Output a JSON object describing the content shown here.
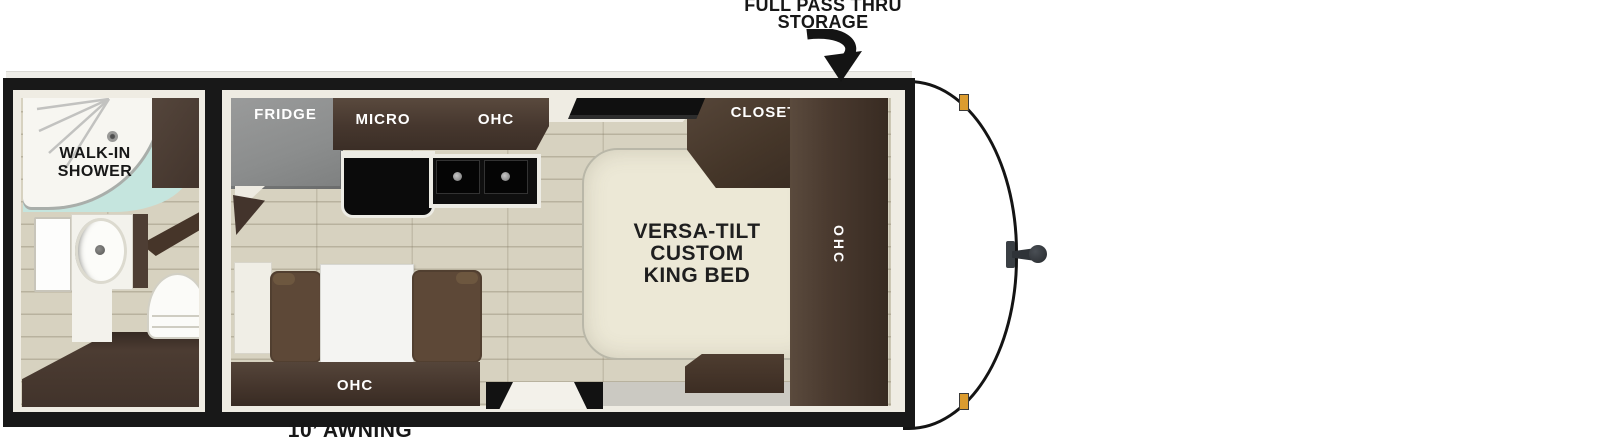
{
  "callouts": {
    "pass_thru_line1": "FULL PASS THRU",
    "pass_thru_line2": "STORAGE",
    "awning": "10’ AWNING"
  },
  "bathroom": {
    "shower_line1": "WALK-IN",
    "shower_line2": "SHOWER"
  },
  "kitchen": {
    "fridge_label": "FRIDGE",
    "micro_label": "MICRO",
    "ohc_label": "OHC"
  },
  "bedroom": {
    "closet_label": "CLOSET",
    "ohc_label": "OHC",
    "bed_line1": "VERSA-TILT",
    "bed_line2": "CUSTOM",
    "bed_line3": "KING BED"
  },
  "dinette": {
    "ohc_label": "OHC"
  },
  "colors": {
    "wall_black": "#181818",
    "trim_white": "#efece3",
    "floor_tan": "#d7d2c0",
    "cabinet_brown": "#4a3a2f",
    "fridge_gray": "#8f9090",
    "mattress_cream": "#ece8d6",
    "shower_glass_teal": "#c5e5de",
    "bench_brown": "#5d4837",
    "table_white": "#f4f4f2",
    "clearance_light_amber": "#dc9c2f",
    "label_dark": "#171717",
    "label_light": "#ffffff"
  }
}
